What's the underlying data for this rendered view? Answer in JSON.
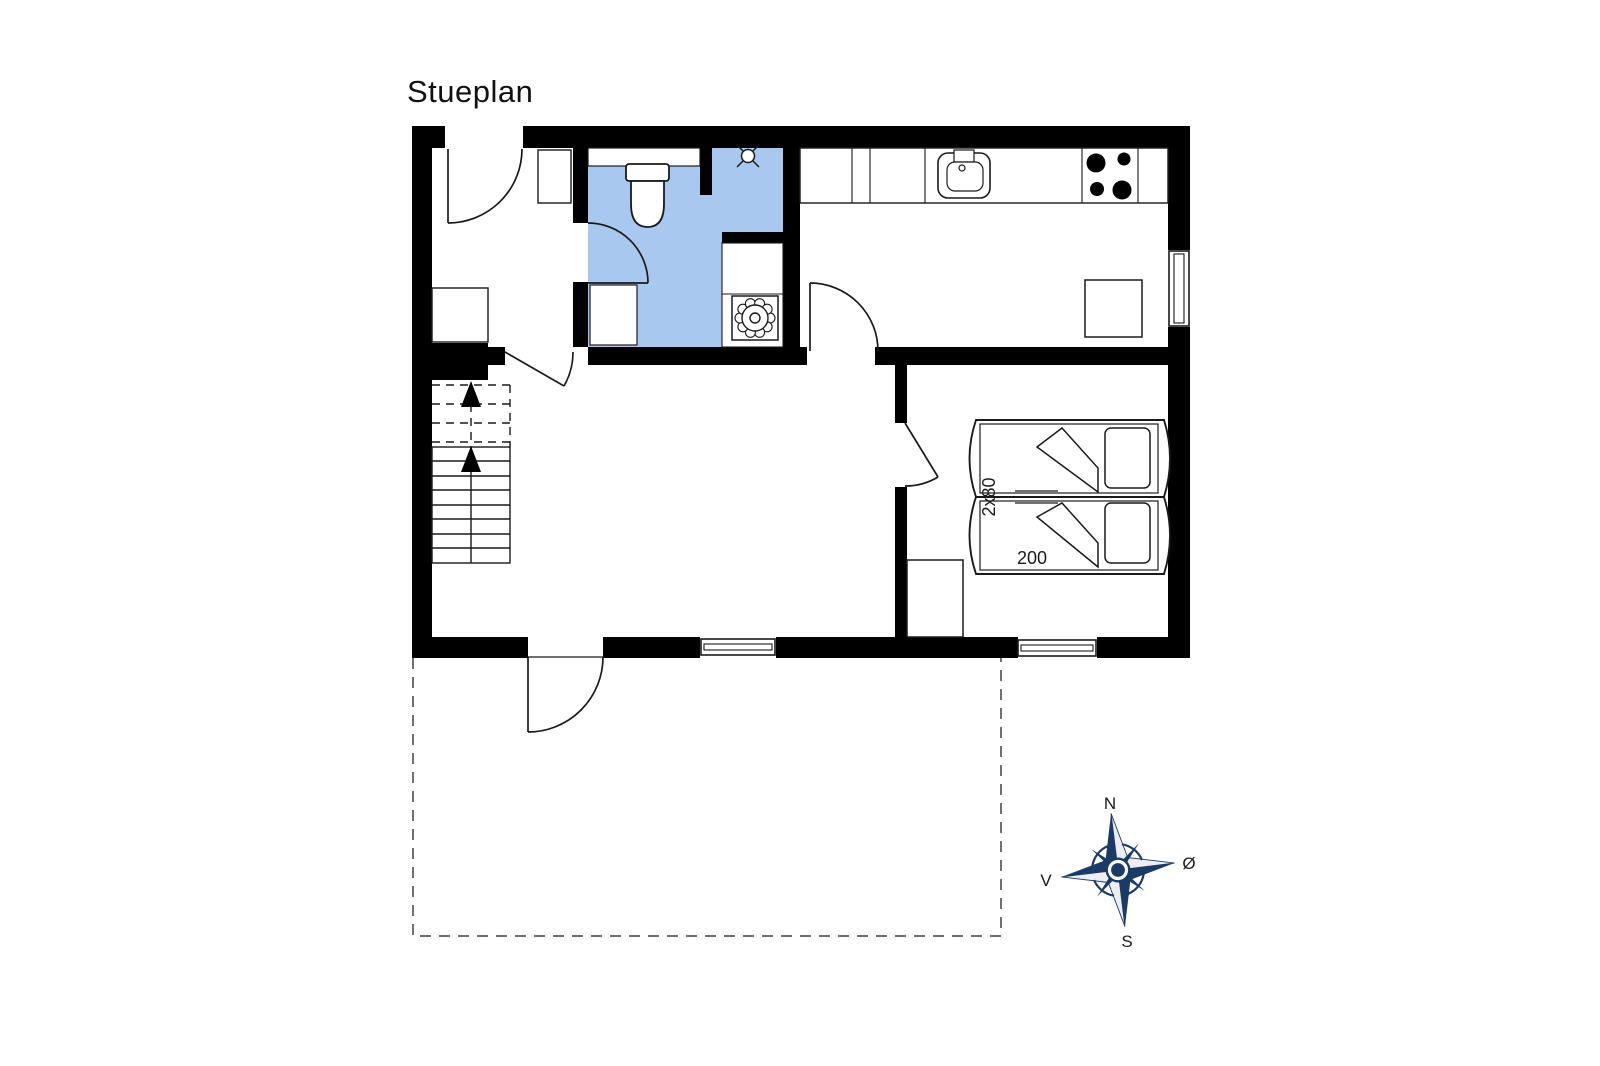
{
  "title": "Stueplan",
  "bed": {
    "width_label": "2x80",
    "length_label": "200"
  },
  "compass": {
    "north": "N",
    "east": "Ø",
    "south": "S",
    "west": "V"
  },
  "colors": {
    "wall": "#000000",
    "line": "#1a1a1a",
    "bathroom_fill": "#A9C8EF",
    "compass_navy": "#1C3A66",
    "compass_light": "#ECEEF2"
  }
}
